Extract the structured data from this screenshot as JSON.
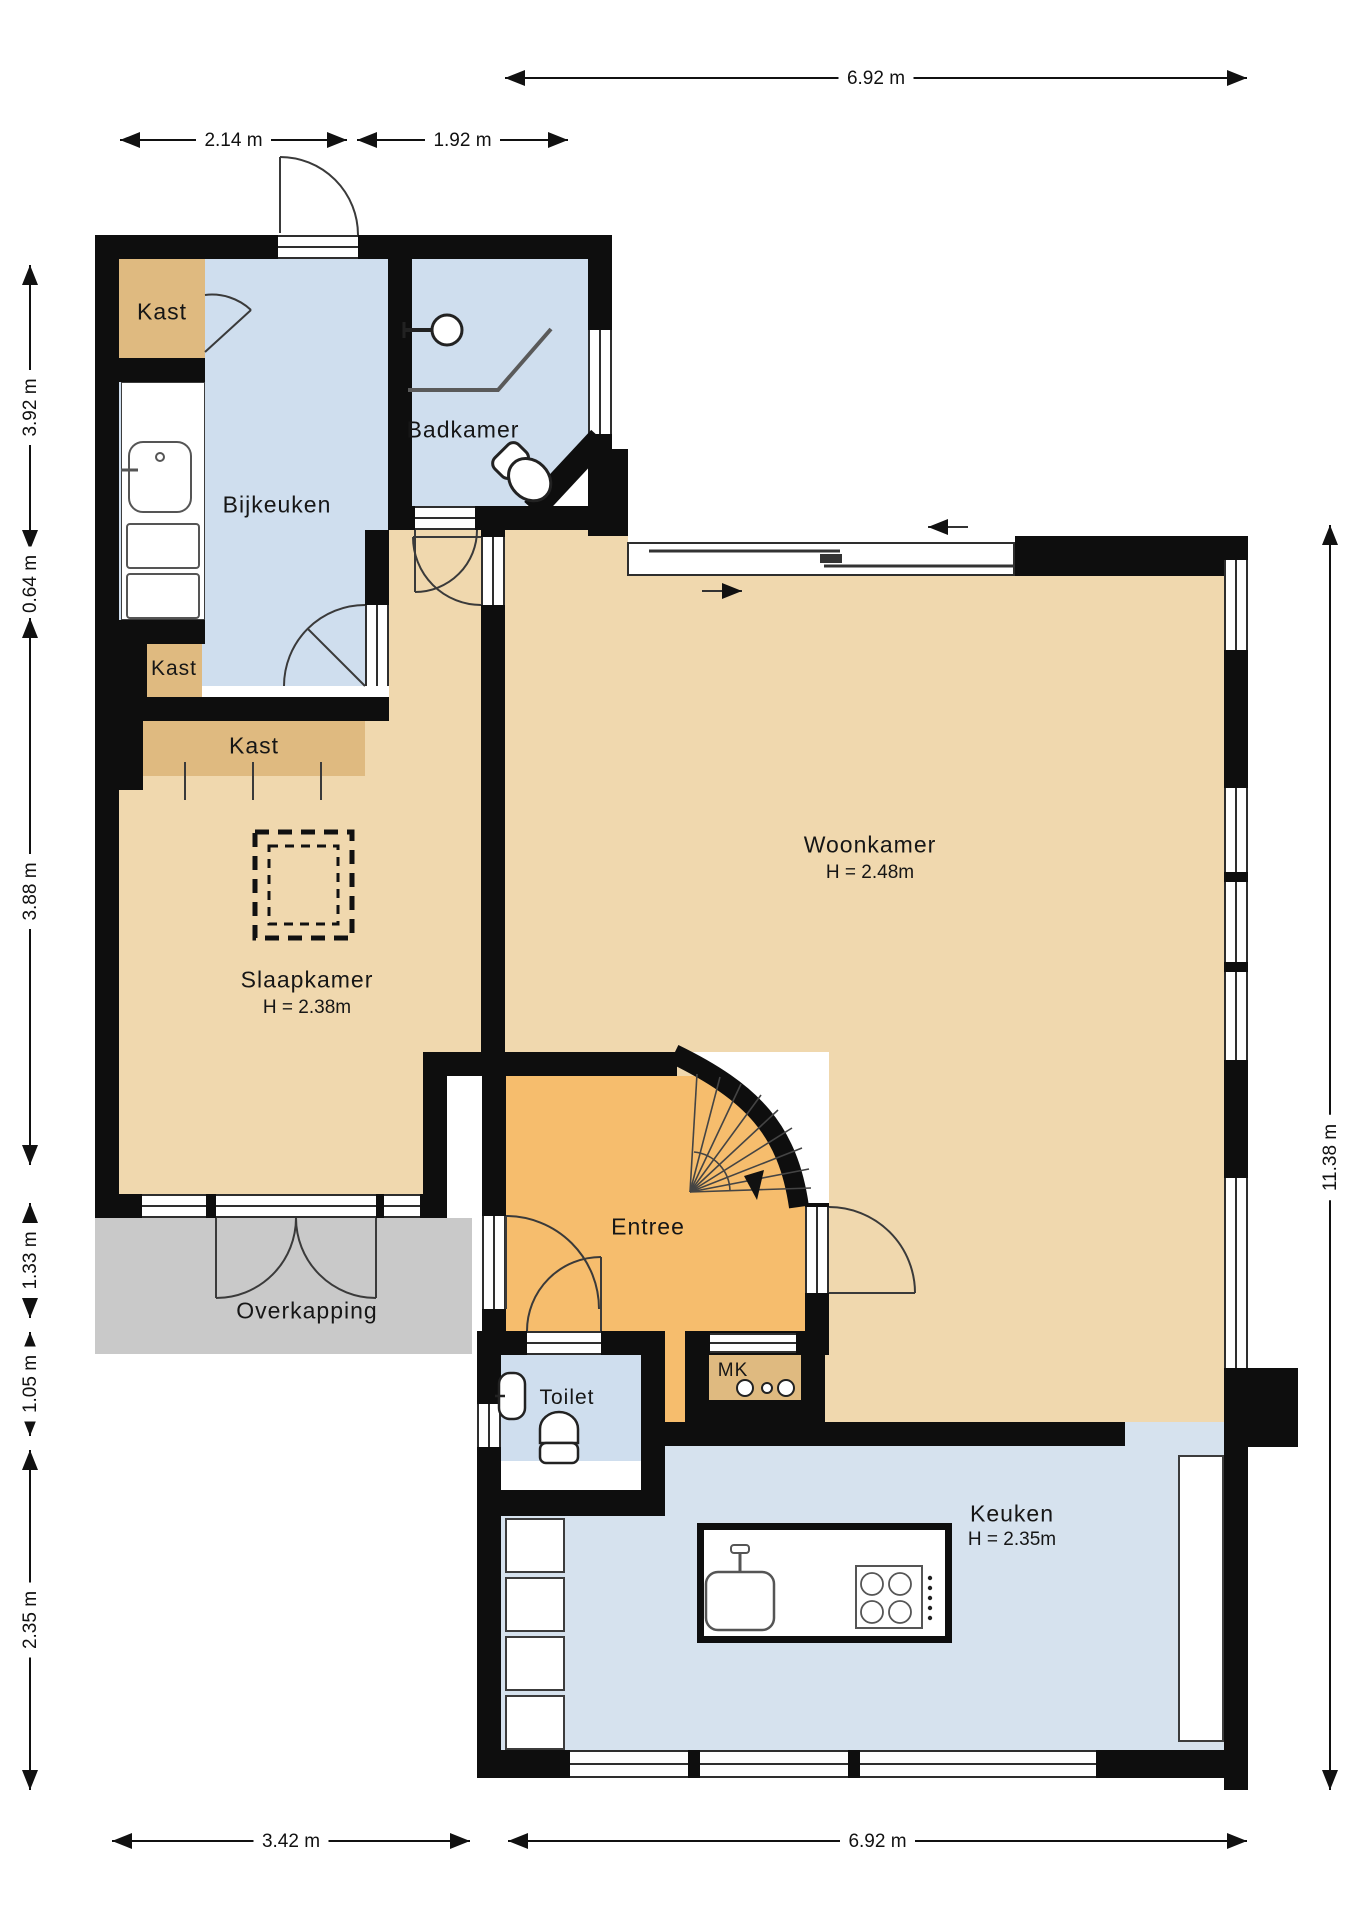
{
  "colors": {
    "wall": "#0e0e0e",
    "blue": "#cfdeee",
    "keuken_blue": "#d6e2ee",
    "tan": "#f0d8ae",
    "kast": "#dfba80",
    "orange": "#f6bd6d",
    "gray": "#c9c9c9"
  },
  "rooms": {
    "kast1": {
      "label": "Kast"
    },
    "bijkeuken": {
      "label": "Bijkeuken"
    },
    "badkamer": {
      "label": "Badkamer"
    },
    "kast2": {
      "label": "Kast"
    },
    "kast3": {
      "label": "Kast"
    },
    "slaapkamer": {
      "label": "Slaapkamer",
      "height": "H = 2.38m"
    },
    "woonkamer": {
      "label": "Woonkamer",
      "height": "H = 2.48m"
    },
    "entree": {
      "label": "Entree"
    },
    "overkapping": {
      "label": "Overkapping"
    },
    "toilet": {
      "label": "Toilet"
    },
    "mk": {
      "label": "MK"
    },
    "keuken": {
      "label": "Keuken",
      "height": "H = 2.35m"
    }
  },
  "dimensions": {
    "top": [
      {
        "id": "dim-top-width",
        "label": "6.92 m"
      }
    ],
    "upper": [
      {
        "id": "dim-bijkeuken-width",
        "label": "2.14 m"
      },
      {
        "id": "dim-badkamer-width",
        "label": "1.92 m"
      }
    ],
    "left": [
      {
        "id": "dim-left-1",
        "label": "3.92 m"
      },
      {
        "id": "dim-left-2",
        "label": "0.64 m"
      },
      {
        "id": "dim-left-3",
        "label": "3.88 m"
      },
      {
        "id": "dim-left-4",
        "label": "1.33 m"
      },
      {
        "id": "dim-left-5",
        "label": "1.05 m"
      },
      {
        "id": "dim-left-6",
        "label": "2.35 m"
      }
    ],
    "right": [
      {
        "id": "dim-right-height",
        "label": "11.38 m"
      }
    ],
    "bottom": [
      {
        "id": "dim-bottom-left",
        "label": "3.42 m"
      },
      {
        "id": "dim-bottom-right",
        "label": "6.92 m"
      }
    ]
  }
}
